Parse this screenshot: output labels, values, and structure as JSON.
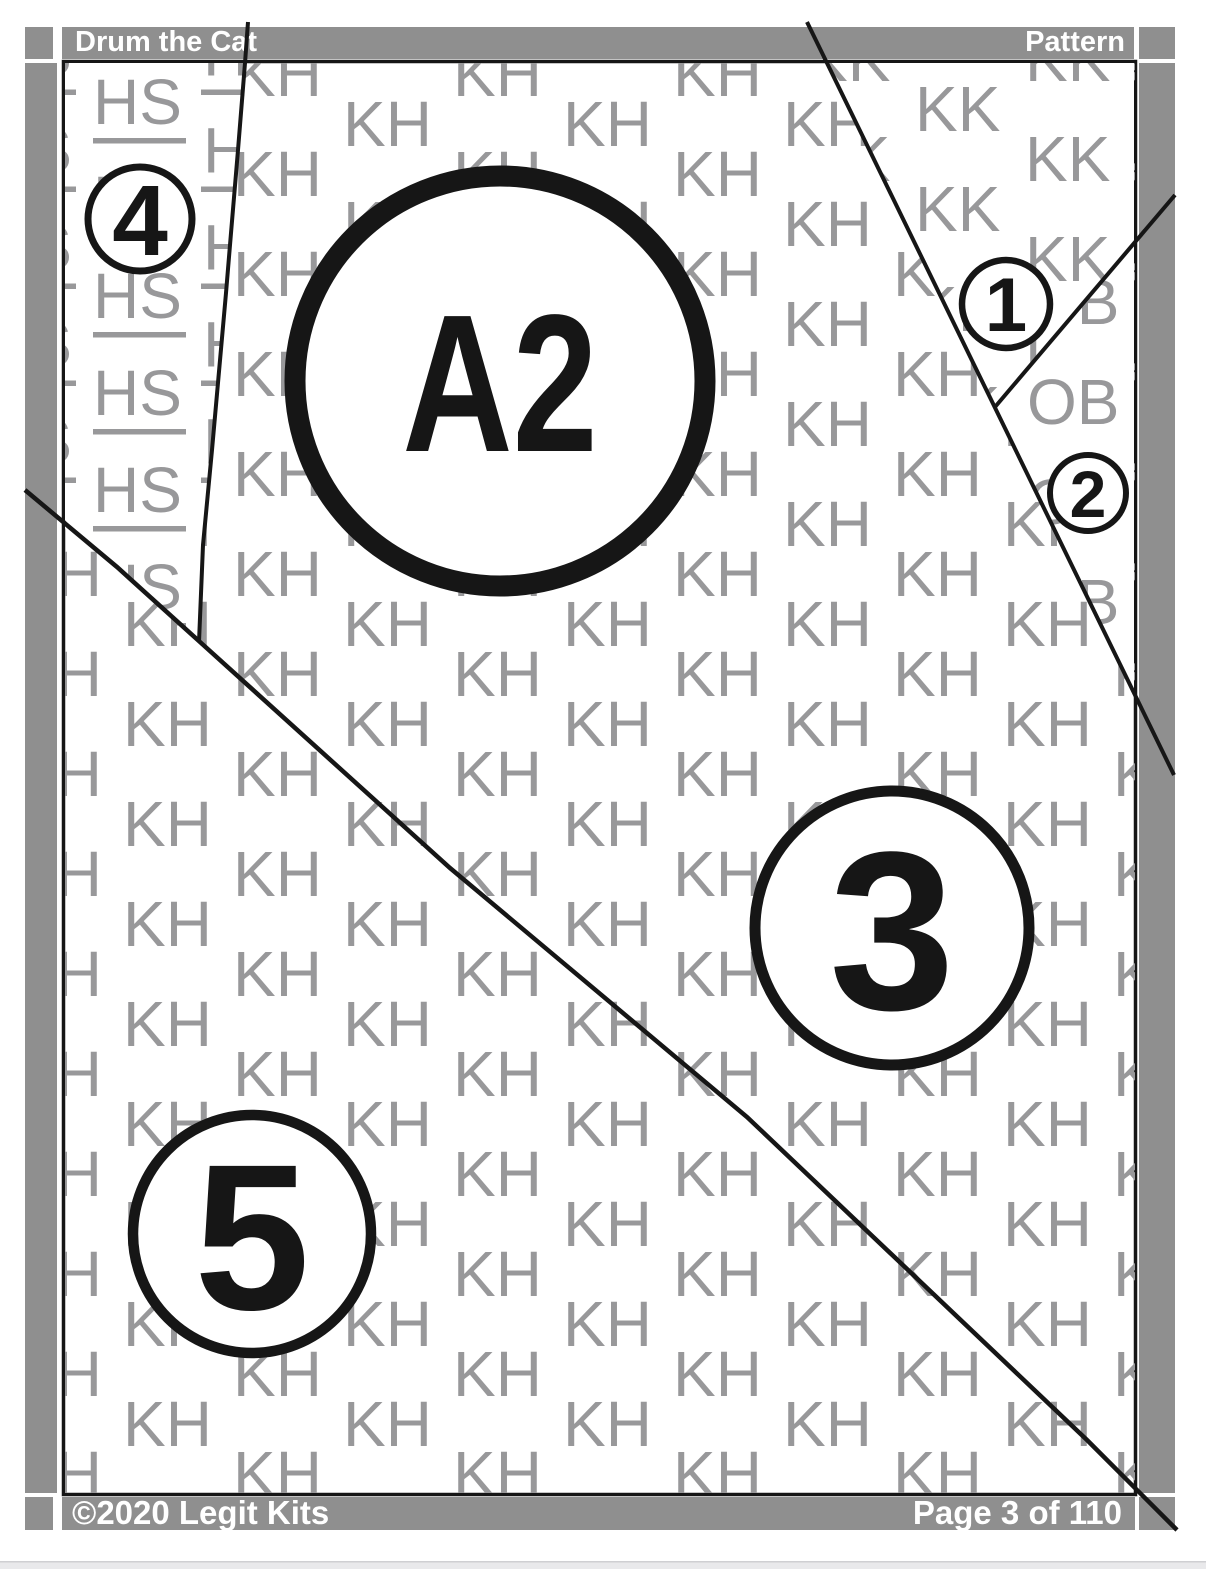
{
  "header": {
    "title": "Drum the Cat",
    "right_label": "Pattern"
  },
  "footer": {
    "copyright": "©2020 Legit Kits",
    "page_indicator": "Page 3 of 110"
  },
  "piece": {
    "label": "A2"
  },
  "sections": {
    "s1": "1",
    "s2": "2",
    "s3": "3",
    "s4": "4",
    "s5": "5"
  },
  "fabric_codes": {
    "kh": "KH",
    "hs": "HS",
    "kk": "KK",
    "ob": "OB"
  },
  "colors": {
    "margin_gray": "#8f8f8f",
    "letter_gray": "#98989a",
    "line_black": "#161616",
    "bottom_strip": "#e9e9eb"
  }
}
